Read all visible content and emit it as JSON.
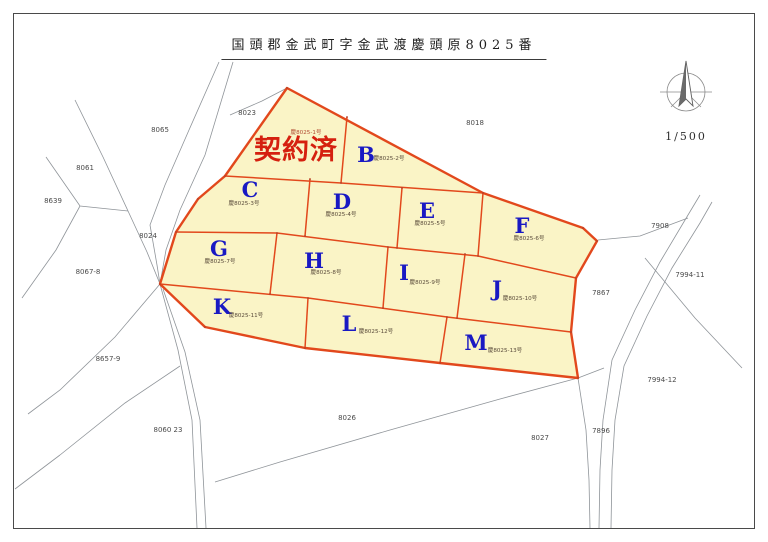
{
  "sheet": {
    "title": "国頭郡金武町字金武渡慶頭原8025番",
    "scale_label": "1/500"
  },
  "map": {
    "colors": {
      "lot_fill": "#FAF4C6",
      "boundary": "#E2481C",
      "letter": "#1919C3",
      "status": "#D5200F",
      "status_sub": "#B04A32",
      "bg_line": "#8F9499",
      "neighbor_text": "#4A4A4A",
      "sublabel_text": "#594A3A",
      "vertex": "#B3402A"
    },
    "outer": [
      [
        287,
        88
      ],
      [
        483,
        193
      ],
      [
        583,
        228
      ],
      [
        597,
        241
      ],
      [
        576,
        278
      ],
      [
        571,
        332
      ],
      [
        578,
        378
      ],
      [
        440,
        363
      ],
      [
        305,
        348
      ],
      [
        205,
        327
      ],
      [
        160,
        284
      ],
      [
        176,
        232
      ],
      [
        198,
        199
      ],
      [
        225,
        176
      ]
    ],
    "inner_lines": [
      [
        [
          225,
          176
        ],
        [
          341,
          183
        ],
        [
          483,
          193
        ]
      ],
      [
        [
          347,
          117
        ],
        [
          341,
          183
        ]
      ],
      [
        [
          310,
          179
        ],
        [
          305,
          236
        ]
      ],
      [
        [
          402,
          188
        ],
        [
          397,
          248
        ]
      ],
      [
        [
          483,
          193
        ],
        [
          478,
          256
        ]
      ],
      [
        [
          176,
          232
        ],
        [
          277,
          233
        ],
        [
          388,
          247
        ],
        [
          478,
          256
        ],
        [
          576,
          278
        ]
      ],
      [
        [
          277,
          233
        ],
        [
          270,
          294
        ]
      ],
      [
        [
          388,
          247
        ],
        [
          383,
          308
        ]
      ],
      [
        [
          465,
          254
        ],
        [
          457,
          318
        ]
      ],
      [
        [
          160,
          284
        ],
        [
          308,
          298
        ],
        [
          447,
          317
        ],
        [
          571,
          332
        ]
      ],
      [
        [
          308,
          298
        ],
        [
          305,
          348
        ]
      ],
      [
        [
          447,
          317
        ],
        [
          440,
          363
        ]
      ]
    ],
    "status_lot": {
      "text": "契約済",
      "x": 296,
      "y": 159,
      "sublabel": "慶8025-1号",
      "sub_x": 306,
      "sub_y": 134
    },
    "lots": [
      {
        "letter": "B",
        "x": 366,
        "y": 162,
        "sublabel": "慶8025-2号",
        "sub_x": 389,
        "sub_y": 160
      },
      {
        "letter": "C",
        "x": 250,
        "y": 197,
        "sublabel": "慶8025-3号",
        "sub_x": 244,
        "sub_y": 205
      },
      {
        "letter": "D",
        "x": 342,
        "y": 209,
        "sublabel": "慶8025-4号",
        "sub_x": 341,
        "sub_y": 216
      },
      {
        "letter": "E",
        "x": 427,
        "y": 218,
        "sublabel": "慶8025-5号",
        "sub_x": 430,
        "sub_y": 225
      },
      {
        "letter": "F",
        "x": 522,
        "y": 233,
        "sublabel": "慶8025-6号",
        "sub_x": 529,
        "sub_y": 240
      },
      {
        "letter": "G",
        "x": 219,
        "y": 256,
        "sublabel": "慶8025-7号",
        "sub_x": 220,
        "sub_y": 263
      },
      {
        "letter": "H",
        "x": 314,
        "y": 268,
        "sublabel": "慶8025-8号",
        "sub_x": 326,
        "sub_y": 274
      },
      {
        "letter": "I",
        "x": 404,
        "y": 280,
        "sublabel": "慶8025-9号",
        "sub_x": 425,
        "sub_y": 284
      },
      {
        "letter": "J",
        "x": 497,
        "y": 296,
        "sublabel": "慶8025-10号",
        "sub_x": 520,
        "sub_y": 300
      },
      {
        "letter": "K",
        "x": 222,
        "y": 314,
        "sublabel": "慶8025-11号",
        "sub_x": 246,
        "sub_y": 317
      },
      {
        "letter": "L",
        "x": 349,
        "y": 331,
        "sublabel": "慶8025-12号",
        "sub_x": 376,
        "sub_y": 333
      },
      {
        "letter": "M",
        "x": 476,
        "y": 350,
        "sublabel": "慶8025-13号",
        "sub_x": 505,
        "sub_y": 352
      }
    ],
    "neighbors": [
      {
        "text": "8023",
        "x": 247,
        "y": 115
      },
      {
        "text": "8065",
        "x": 160,
        "y": 132
      },
      {
        "text": "8061",
        "x": 85,
        "y": 170
      },
      {
        "text": "8639",
        "x": 53,
        "y": 203
      },
      {
        "text": "8024",
        "x": 148,
        "y": 238
      },
      {
        "text": "8067-8",
        "x": 88,
        "y": 274
      },
      {
        "text": "8657-9",
        "x": 108,
        "y": 361
      },
      {
        "text": "8060 23",
        "x": 168,
        "y": 432
      },
      {
        "text": "8026",
        "x": 347,
        "y": 420
      },
      {
        "text": "8018",
        "x": 475,
        "y": 125
      },
      {
        "text": "7908",
        "x": 660,
        "y": 228
      },
      {
        "text": "7994-11",
        "x": 690,
        "y": 277
      },
      {
        "text": "7867",
        "x": 601,
        "y": 295
      },
      {
        "text": "7994-12",
        "x": 662,
        "y": 382
      },
      {
        "text": "7896",
        "x": 601,
        "y": 433
      },
      {
        "text": "8027",
        "x": 540,
        "y": 440
      }
    ],
    "bg_lines": [
      [
        [
          233,
          62
        ],
        [
          205,
          155
        ],
        [
          180,
          210
        ],
        [
          166,
          250
        ],
        [
          160,
          284
        ]
      ],
      [
        [
          219,
          62
        ],
        [
          189,
          130
        ],
        [
          165,
          185
        ],
        [
          150,
          225
        ],
        [
          157,
          265
        ],
        [
          160,
          284
        ]
      ],
      [
        [
          75,
          100
        ],
        [
          103,
          157
        ],
        [
          128,
          211
        ],
        [
          147,
          252
        ],
        [
          160,
          284
        ]
      ],
      [
        [
          46,
          157
        ],
        [
          80,
          206
        ],
        [
          128,
          211
        ]
      ],
      [
        [
          80,
          206
        ],
        [
          56,
          250
        ],
        [
          22,
          298
        ]
      ],
      [
        [
          160,
          284
        ],
        [
          115,
          337
        ],
        [
          60,
          390
        ],
        [
          28,
          414
        ]
      ],
      [
        [
          160,
          284
        ],
        [
          178,
          350
        ],
        [
          192,
          420
        ],
        [
          197,
          528
        ]
      ],
      [
        [
          163,
          289
        ],
        [
          185,
          352
        ],
        [
          200,
          420
        ],
        [
          206,
          528
        ]
      ],
      [
        [
          60,
          455
        ],
        [
          125,
          403
        ],
        [
          180,
          366
        ]
      ],
      [
        [
          15,
          489
        ],
        [
          60,
          455
        ]
      ],
      [
        [
          578,
          378
        ],
        [
          500,
          399
        ],
        [
          390,
          430
        ],
        [
          280,
          462
        ],
        [
          215,
          482
        ]
      ],
      [
        [
          700,
          195
        ],
        [
          688,
          215
        ],
        [
          660,
          262
        ],
        [
          635,
          310
        ],
        [
          612,
          360
        ],
        [
          603,
          420
        ],
        [
          600,
          470
        ],
        [
          599,
          528
        ]
      ],
      [
        [
          712,
          202
        ],
        [
          700,
          223
        ],
        [
          672,
          268
        ],
        [
          647,
          316
        ],
        [
          624,
          366
        ],
        [
          615,
          420
        ],
        [
          612,
          470
        ],
        [
          611,
          528
        ]
      ],
      [
        [
          598,
          240
        ],
        [
          640,
          236
        ],
        [
          688,
          218
        ]
      ],
      [
        [
          645,
          258
        ],
        [
          695,
          318
        ],
        [
          742,
          368
        ]
      ],
      [
        [
          578,
          378
        ],
        [
          586,
          430
        ],
        [
          589,
          480
        ],
        [
          590,
          528
        ]
      ],
      [
        [
          578,
          378
        ],
        [
          604,
          368
        ]
      ],
      [
        [
          230,
          115
        ],
        [
          262,
          101
        ],
        [
          287,
          88
        ]
      ]
    ]
  }
}
